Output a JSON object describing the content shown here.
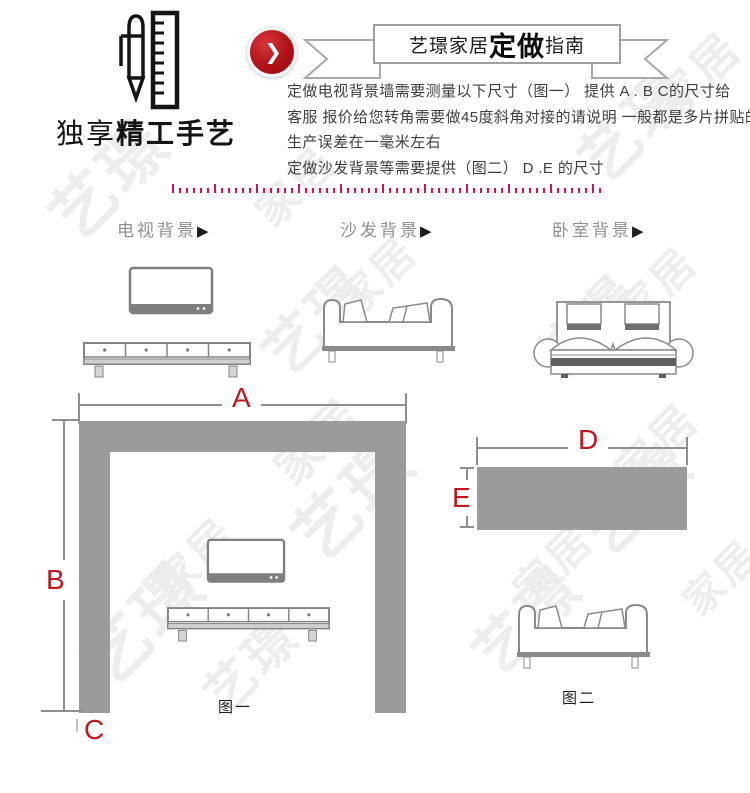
{
  "logo": {
    "text_light": "独享",
    "text_bold": "精工手艺",
    "icon": "pen-ruler-icon"
  },
  "header": {
    "play_glyph": "❯"
  },
  "banner": {
    "prefix": "艺璟家居",
    "bold": "定做",
    "suffix": "指南"
  },
  "intro": {
    "lines": [
      "定做电视背景墙需要测量以下尺寸（图一） 提供 A . B  C的尺寸给",
      "客服 报价给您转角需要做45度斜角对接的请说明  一般都是多片拼贴的",
      "生产误差在一毫米左右",
      "定做沙发背景等需要提供（图二）  D .E 的尺寸"
    ]
  },
  "categories": [
    {
      "label": "电视背景",
      "arrow": "▶"
    },
    {
      "label": "沙发背景",
      "arrow": "▶"
    },
    {
      "label": "卧室背景",
      "arrow": "▶"
    }
  ],
  "figure1": {
    "caption": "图一",
    "label_a": "A",
    "label_b": "B",
    "label_c": "C"
  },
  "figure2": {
    "caption": "图二",
    "label_d": "D",
    "label_e": "E"
  },
  "watermarks": [
    {
      "text": "家居",
      "x": 648,
      "y": 52,
      "size": 46,
      "rot": -45
    },
    {
      "text": "艺璟",
      "x": 572,
      "y": 96,
      "size": 60,
      "rot": -45
    },
    {
      "text": "艺璟",
      "x": 42,
      "y": 148,
      "size": 64,
      "rot": -45
    },
    {
      "text": "家居",
      "x": 250,
      "y": 166,
      "size": 42,
      "rot": -45
    },
    {
      "text": "家居",
      "x": 332,
      "y": 256,
      "size": 42,
      "rot": -45
    },
    {
      "text": "艺璟",
      "x": 256,
      "y": 292,
      "size": 58,
      "rot": -45
    },
    {
      "text": "家居",
      "x": 612,
      "y": 266,
      "size": 42,
      "rot": -45
    },
    {
      "text": "艺璟",
      "x": 528,
      "y": 300,
      "size": 56,
      "rot": -45
    },
    {
      "text": "家居",
      "x": 268,
      "y": 418,
      "size": 46,
      "rot": -45
    },
    {
      "text": "艺璟",
      "x": 284,
      "y": 466,
      "size": 66,
      "rot": -45
    },
    {
      "text": "家居",
      "x": 610,
      "y": 424,
      "size": 44,
      "rot": -45
    },
    {
      "text": "艺璟",
      "x": 574,
      "y": 470,
      "size": 60,
      "rot": -45
    },
    {
      "text": "家居",
      "x": 148,
      "y": 538,
      "size": 44,
      "rot": -45
    },
    {
      "text": "艺璟",
      "x": 74,
      "y": 590,
      "size": 66,
      "rot": -45
    },
    {
      "text": "家居",
      "x": 508,
      "y": 544,
      "size": 42,
      "rot": -45
    },
    {
      "text": "艺璟",
      "x": 466,
      "y": 592,
      "size": 58,
      "rot": -45
    },
    {
      "text": "家居",
      "x": 678,
      "y": 558,
      "size": 40,
      "rot": -45
    },
    {
      "text": "艺璟",
      "x": 198,
      "y": 640,
      "size": 50,
      "rot": -45
    }
  ],
  "colors": {
    "accent_red": "#c0181e",
    "button_red": "#b01218",
    "dotted_line": "#d4114e",
    "block_gray": "#9b9b9b",
    "line_gray": "#8f8f8f",
    "text_dark": "#3f3f3f",
    "watermark": "#ededed"
  }
}
